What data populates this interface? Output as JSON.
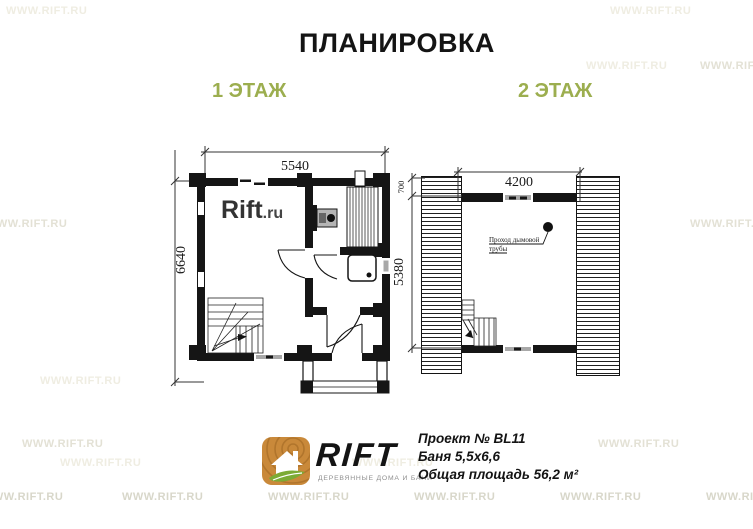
{
  "title": "ПЛАНИРОВКА",
  "watermark": {
    "text": "WWW.RIFT.RU"
  },
  "floor1": {
    "label": "1 ЭТАЖ",
    "dim_width": "5540",
    "dim_height": "6640",
    "plan_brand": "Rift",
    "plan_brand_tld": ".ru"
  },
  "floor2": {
    "label": "2 ЭТАЖ",
    "dim_width": "4200",
    "dim_top": "700",
    "dim_height": "5380",
    "chimney_note_line1": "Проход дымовой",
    "chimney_note_line2": "трубы"
  },
  "footer": {
    "brand": "RIFT",
    "brand_tagline": "ДЕРЕВЯННЫЕ ДОМА И БАНИ",
    "project_lines": [
      "Проект № BL11",
      "Баня 5,5х6,6",
      "Общая площадь 56,2 м²"
    ]
  },
  "colors": {
    "accent_green": "#9cae4f",
    "logo_orange": "#c9893a",
    "leaf_green": "#7cab35",
    "wall_black": "#151515",
    "watermark_gray": "#d8d7ca"
  }
}
